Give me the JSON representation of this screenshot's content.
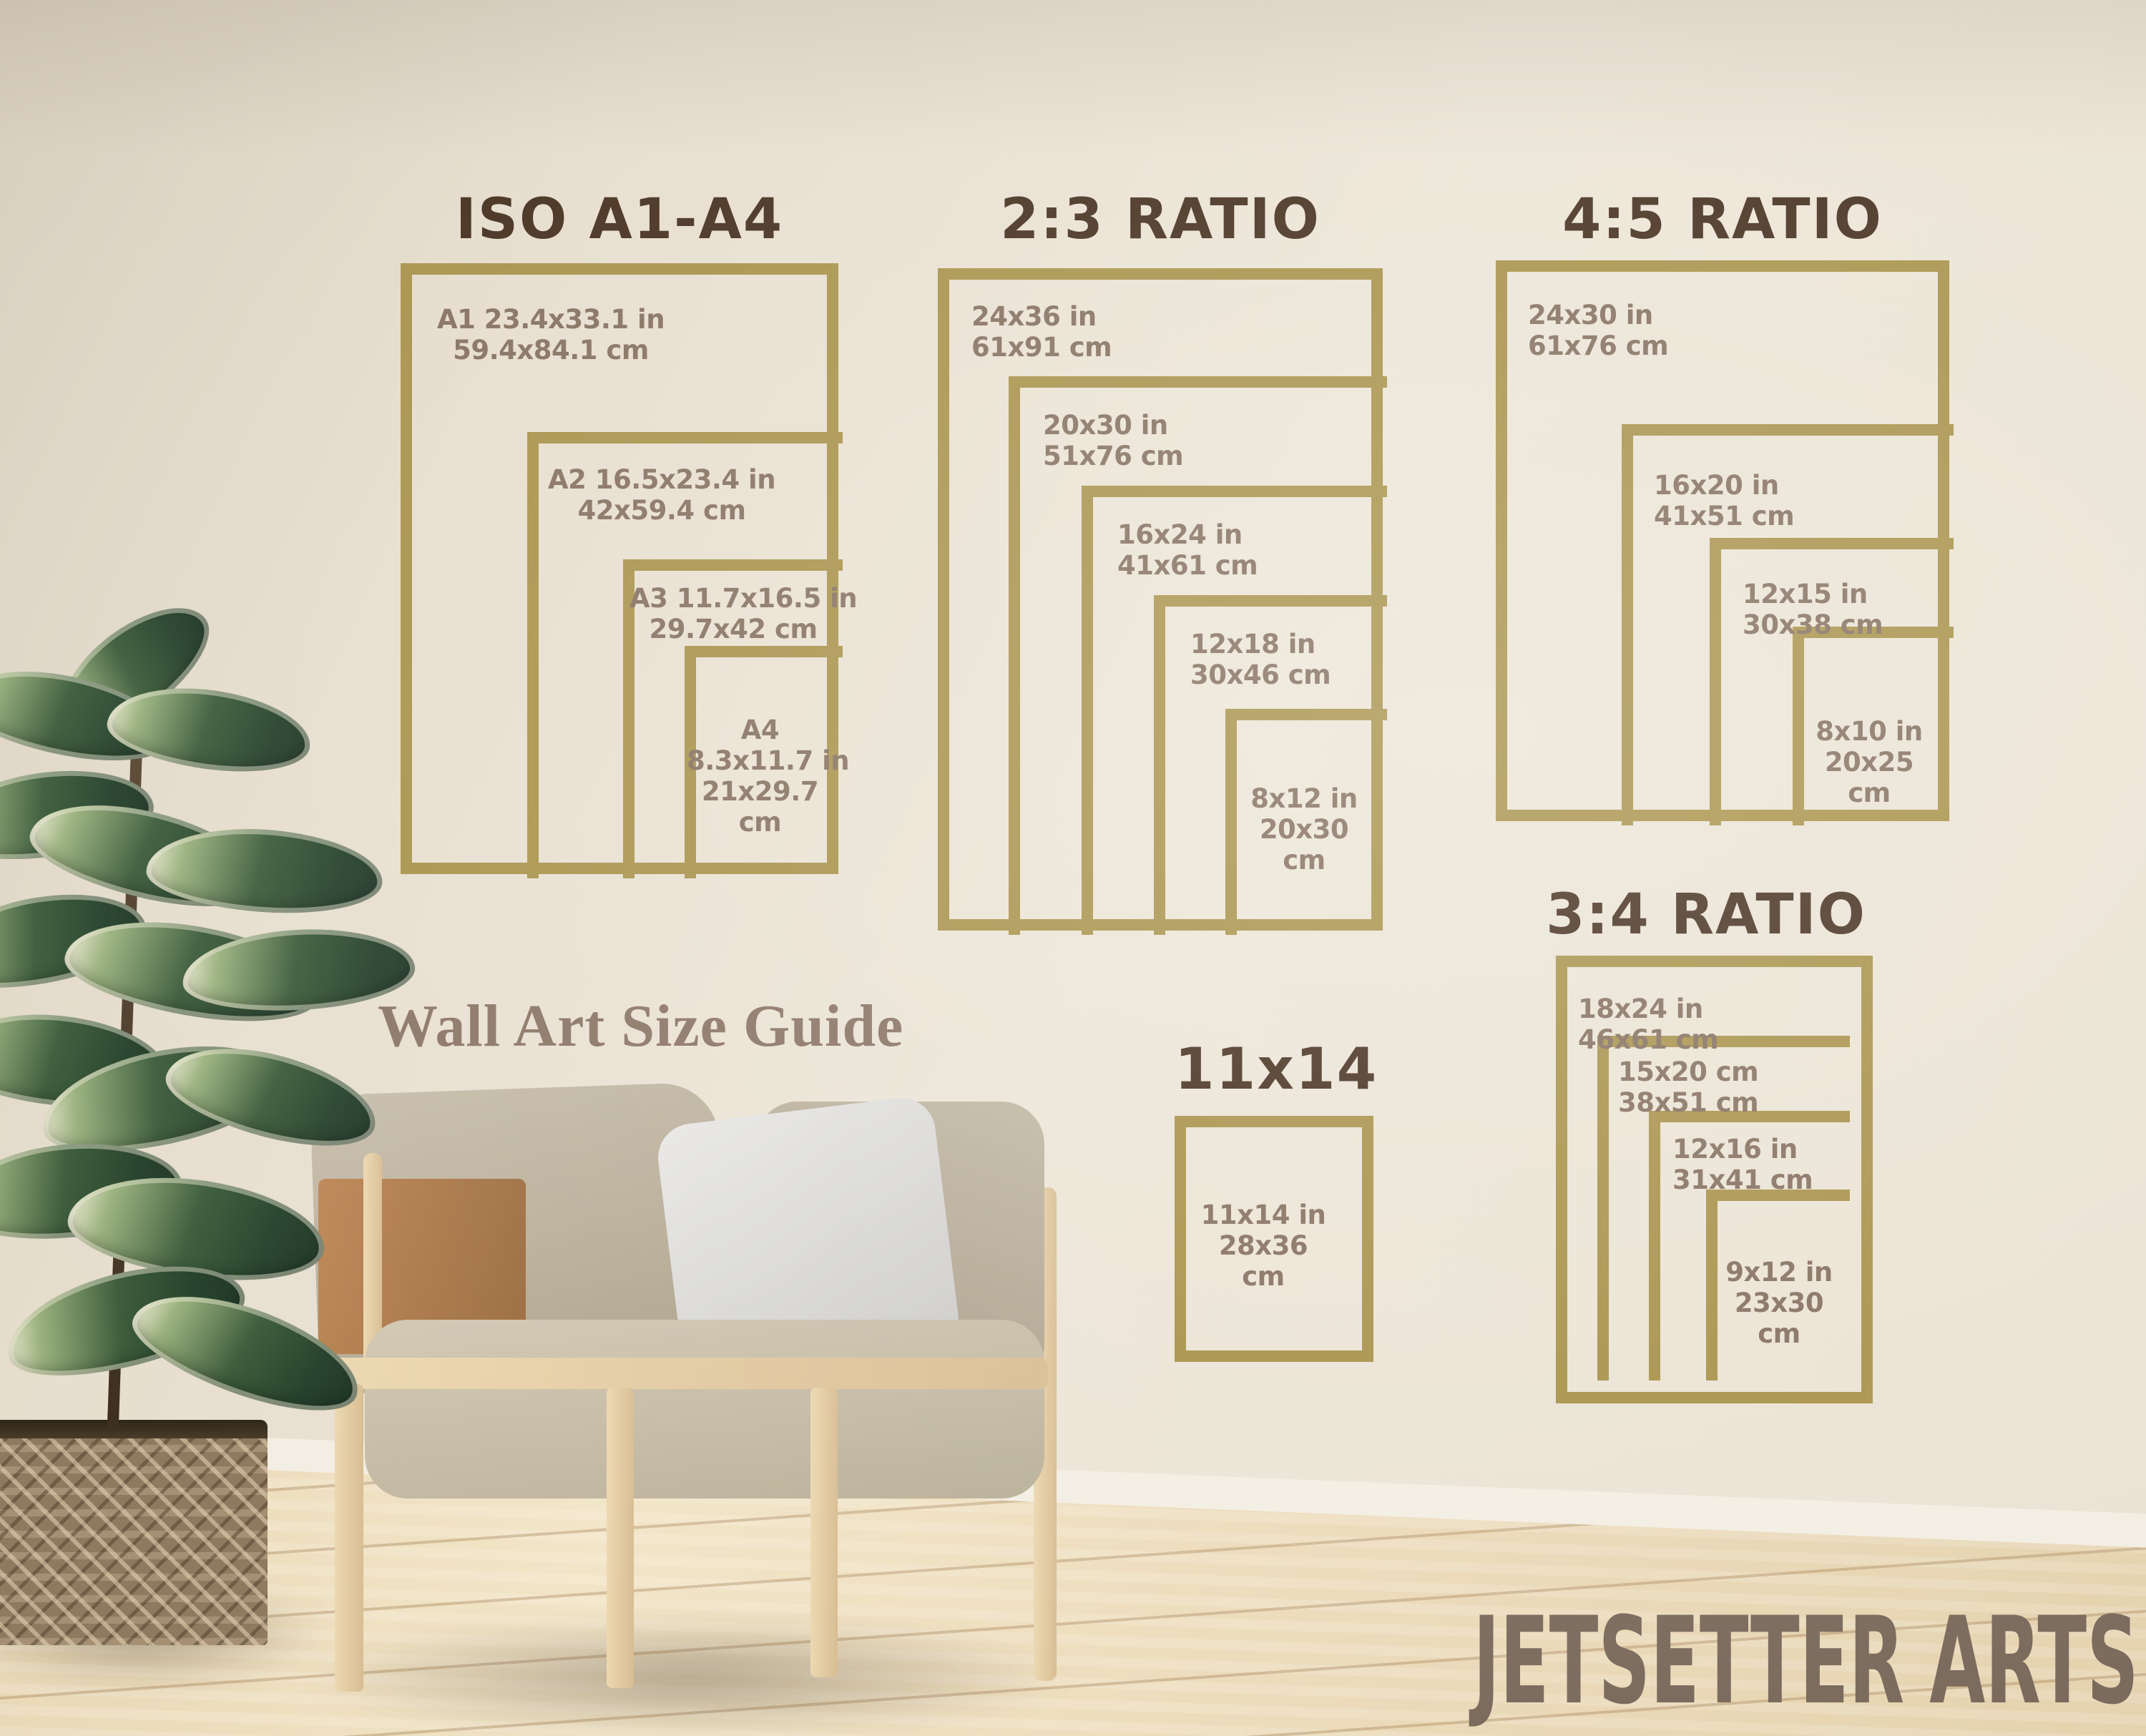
{
  "scene": {
    "caption": "Wall Art Size Guide",
    "watermark": "JETSETTER ARTS"
  },
  "colors": {
    "frame_gold": "#a8924a",
    "title_brown": "#46301f",
    "label_brown": "#85705f",
    "caption_brown": "#8a7464",
    "watermark_brown": "#7b6b5d",
    "wall": "#ece5d7",
    "floor_wood": "#efe0bf"
  },
  "groups": [
    {
      "title": "ISO A1-A4",
      "sizes": [
        {
          "name": "A1",
          "lines": [
            "A1 23.4x33.1 in",
            "59.4x84.1 cm"
          ]
        },
        {
          "name": "A2",
          "lines": [
            "A2 16.5x23.4 in",
            "42x59.4 cm"
          ]
        },
        {
          "name": "A3",
          "lines": [
            "A3 11.7x16.5 in",
            "29.7x42 cm"
          ]
        },
        {
          "name": "A4",
          "lines": [
            "A4",
            "8.3x11.7 in",
            "21x29.7",
            "cm"
          ]
        }
      ]
    },
    {
      "title": "2:3 RATIO",
      "sizes": [
        {
          "name": "24x36",
          "lines": [
            "24x36 in",
            "61x91 cm"
          ]
        },
        {
          "name": "20x30",
          "lines": [
            "20x30 in",
            "51x76 cm"
          ]
        },
        {
          "name": "16x24",
          "lines": [
            "16x24 in",
            "41x61 cm"
          ]
        },
        {
          "name": "12x18",
          "lines": [
            "12x18 in",
            "30x46 cm"
          ]
        },
        {
          "name": "8x12",
          "lines": [
            "8x12 in",
            "20x30",
            "cm"
          ]
        }
      ]
    },
    {
      "title": "4:5 RATIO",
      "sizes": [
        {
          "name": "24x30",
          "lines": [
            "24x30 in",
            "61x76 cm"
          ]
        },
        {
          "name": "16x20",
          "lines": [
            "16x20 in",
            "41x51 cm"
          ]
        },
        {
          "name": "12x15",
          "lines": [
            "12x15 in",
            "30x38 cm"
          ]
        },
        {
          "name": "8x10",
          "lines": [
            "8x10 in",
            "20x25",
            "cm"
          ]
        }
      ]
    },
    {
      "title": "3:4 RATIO",
      "sizes": [
        {
          "name": "18x24",
          "lines": [
            "18x24 in",
            "46x61 cm"
          ]
        },
        {
          "name": "15x20",
          "lines": [
            "15x20 cm",
            "38x51 cm"
          ]
        },
        {
          "name": "12x16",
          "lines": [
            "12x16 in",
            "31x41 cm"
          ]
        },
        {
          "name": "9x12",
          "lines": [
            "9x12 in",
            "23x30",
            "cm"
          ]
        }
      ]
    },
    {
      "title": "11x14",
      "sizes": [
        {
          "name": "11x14",
          "lines": [
            "11x14 in",
            "28x36",
            "cm"
          ]
        }
      ]
    }
  ]
}
